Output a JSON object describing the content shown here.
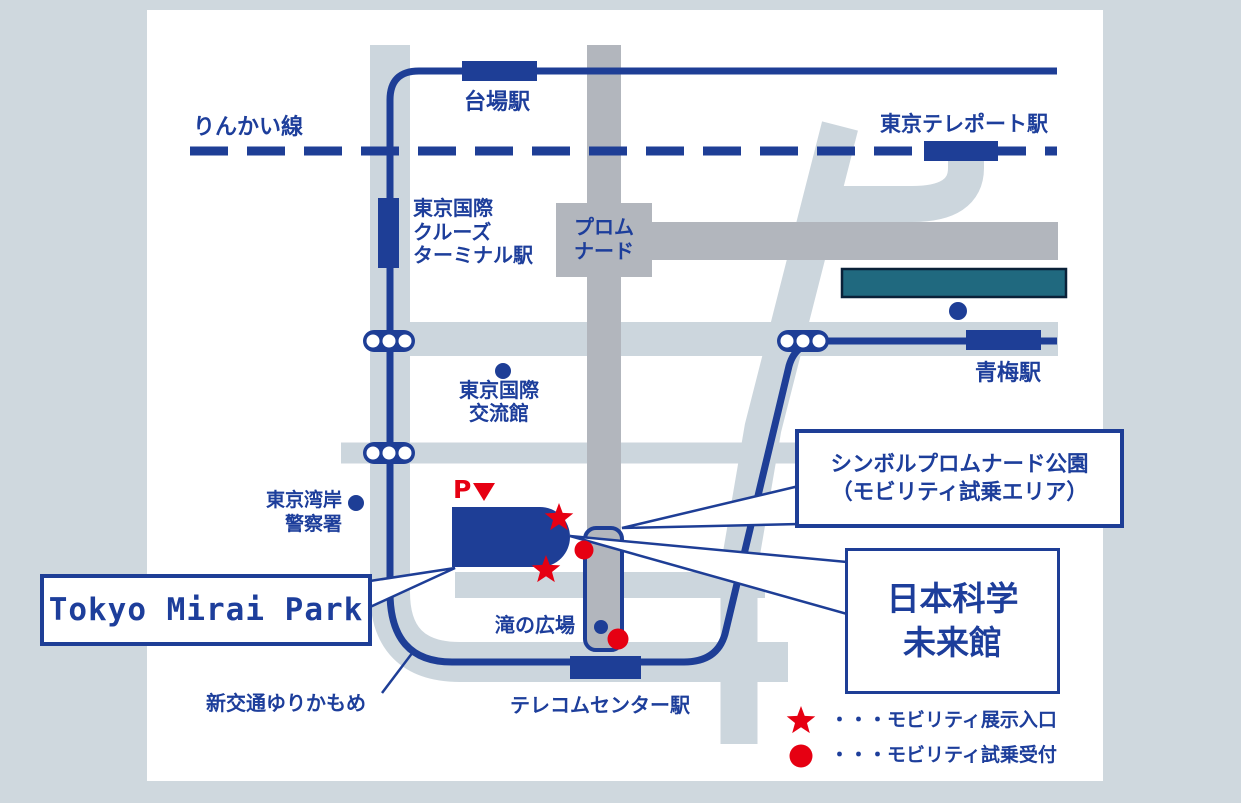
{
  "colors": {
    "navy": "#1e3e96",
    "navy_text": "#1d3e9b",
    "red": "#e60012",
    "light_road": "#ccd6dd",
    "dark_road": "#b2b6bd",
    "outer_bg": "#cfd8de",
    "teal": "#20697f",
    "teal_border": "#0a2138",
    "panel": "#ffffff"
  },
  "labels": {
    "rinkai_line": "りんかい線",
    "daiba_station": "台場駅",
    "tokyo_teleport_station": "東京テレポート駅",
    "cruise_terminal_station": [
      "東京国際",
      "クルーズ",
      "ターミナル駅"
    ],
    "promenade": [
      "プロム",
      "ナード"
    ],
    "aomi_station": "青梅駅",
    "exchange_center": [
      "東京国際",
      "交流館"
    ],
    "police_station": [
      "東京湾岸",
      "警察署"
    ],
    "parking": "P",
    "taki_plaza": "滝の広場",
    "telecom_center_station": "テレコムセンター駅",
    "yurikamome_line": "新交通ゆりかもめ",
    "mirai_park": "Tokyo Mirai Park",
    "promenade_park_callout": [
      "シンボルプロムナード公園",
      "（モビリティ試乗エリア）"
    ],
    "miraikan_callout": [
      "日本科学",
      "未来館"
    ]
  },
  "legend": {
    "star_label": "・・・モビリティ展示入口",
    "circle_label": "・・・モビリティ試乗受付"
  }
}
